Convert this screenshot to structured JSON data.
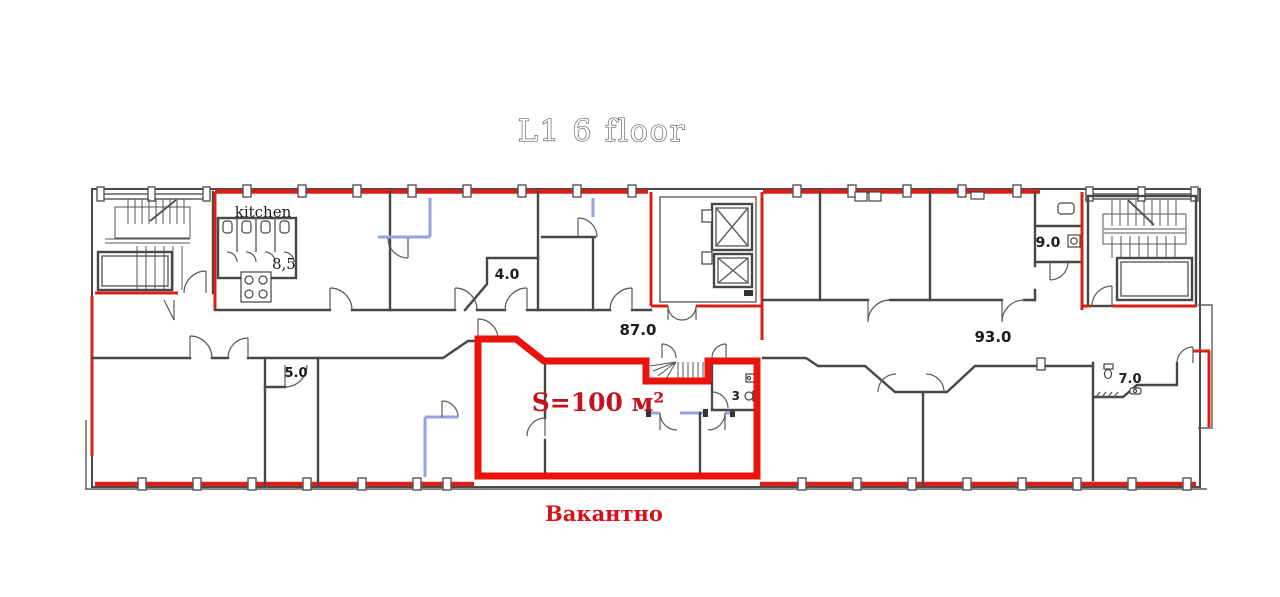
{
  "title": "L1  6 floor",
  "rooms": {
    "kitchen": "kitchen",
    "kitchen_wc_area": "8,5",
    "small_room_4": "4.0",
    "left_wing_area": "87.0",
    "right_wing_area": "93.0",
    "room_9": "9.0",
    "room_5": "5.0",
    "vacant_wc": "3",
    "wc_room_7": "7.0"
  },
  "vacant_unit": {
    "area_label": "S=100 м²",
    "status_label": "Вакантно"
  },
  "colors": {
    "vacant_outline_red": "#ea120b",
    "perimeter_red": "#d8201a",
    "wall_gray": "#474747",
    "partition_blue": "#98a0e2",
    "area_text_red": "#c3131f",
    "status_text_red": "#d4121b",
    "title_outline_gray": "#3f3f3f"
  }
}
